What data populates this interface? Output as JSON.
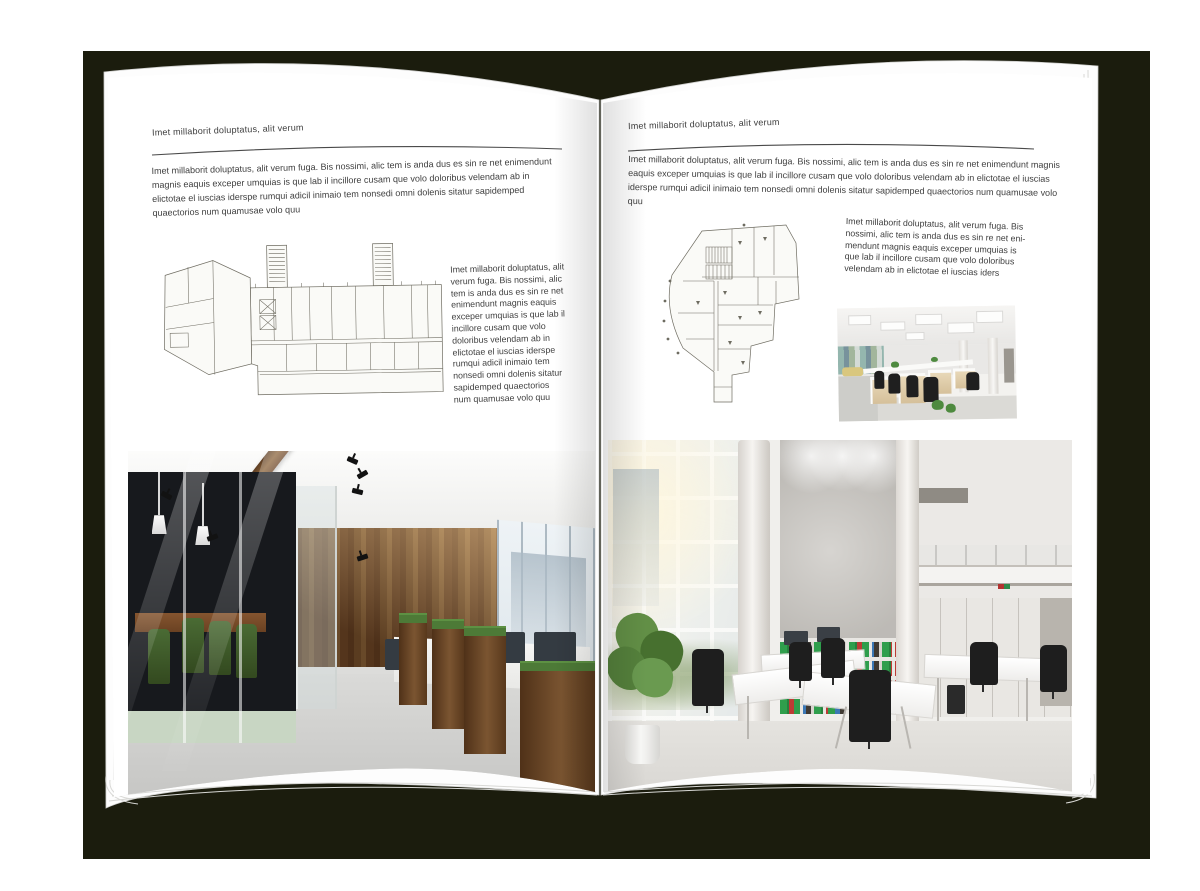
{
  "book": {
    "cover_color": "#1b1c0d",
    "page_color": "#ffffff",
    "left_page": {
      "header": "Imet millaborit doluptatus, alit verum",
      "intro": "Imet millaborit doluptatus, alit verum fuga. Bis nossimi, alic tem is anda dus es sin re net enimendunt magnis eaquis exceper umquias is que lab il incillore cusam que volo doloribus velendam ab in elictotae el iuscias iderspe rumqui adicil inimaio tem nonsedi omni dolenis sitatur sapidemped quaectorios num quamusae volo quu",
      "side_text": "Imet millaborit doluptatus, alit verum fuga. Bis nossimi, alic tem is anda dus es sin re net enimendunt magnis eaquis exceper umquias is que lab il incillore cusam que volo doloribus velendam ab in elictotae el iuscias iderspe rumqui adicil inimaio tem nonsedi omni dolenis sitatur sapidemped quaectorios num quamusae volo quu"
    },
    "right_page": {
      "header": "Imet millaborit doluptatus, alit verum",
      "intro": "Imet millaborit doluptatus, alit verum fuga. Bis nossimi, alic tem is anda dus es sin re net enimendunt magnis eaquis exceper umquias is que lab il incillore cusam que volo doloribus velendam ab in elictotae el iuscias iderspe rumqui adicil inimaio tem nonsedi omni dolenis sitatur sapidemped quaectorios num quamusae volo quu",
      "side_text": "Imet millaborit doluptatus, alit verum fuga. Bis nossimi, alic tem is anda dus es sin re net eni-mendunt magnis eaquis exceper umquias is que lab il incillore cusam que volo doloribus velendam ab in elictotae el iuscias iders"
    }
  }
}
